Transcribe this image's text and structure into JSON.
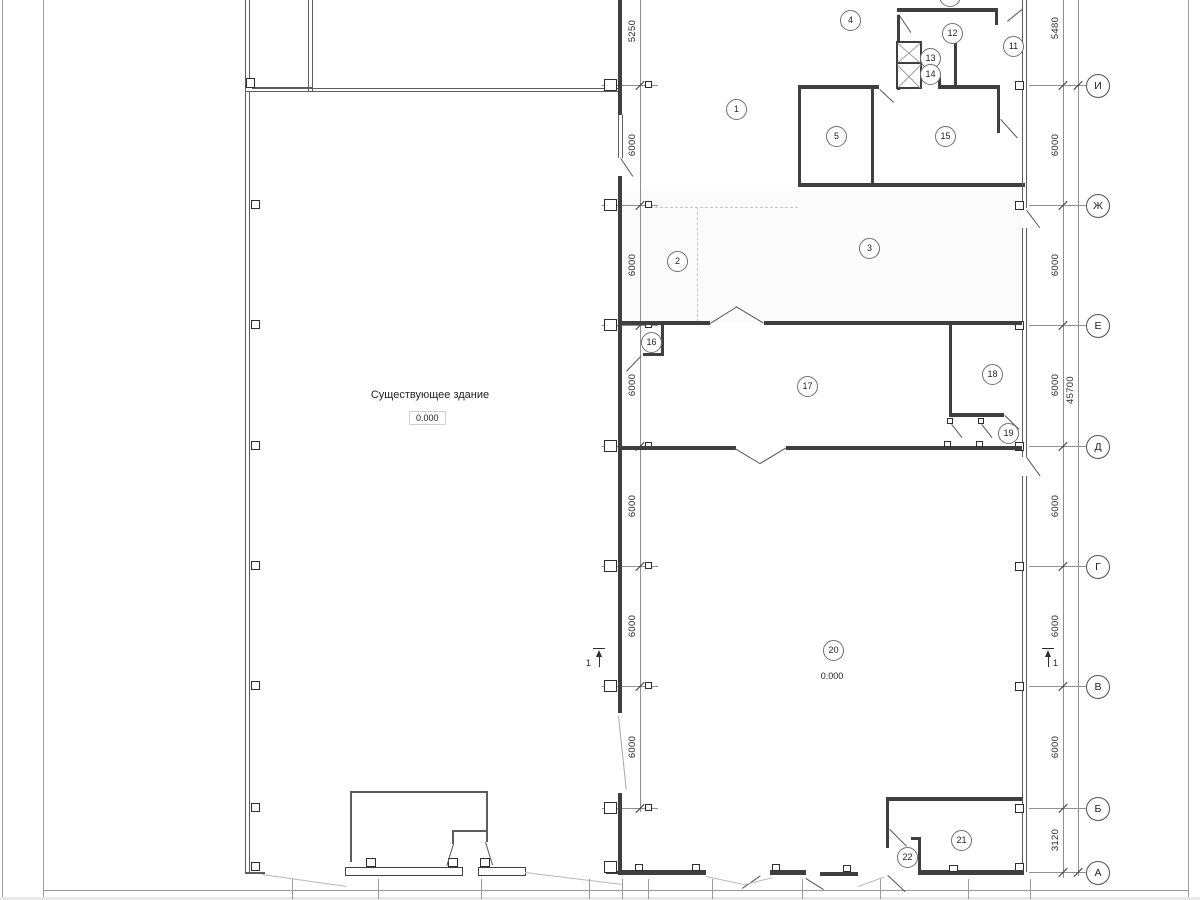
{
  "sheet": {
    "building_label": "Существующее здание",
    "elevation_boxed": "0.000",
    "elevation_floor": "0.000"
  },
  "rooms": [
    {
      "n": "1"
    },
    {
      "n": "2"
    },
    {
      "n": "3"
    },
    {
      "n": "4"
    },
    {
      "n": "5"
    },
    {
      "n": "11"
    },
    {
      "n": "12"
    },
    {
      "n": "13"
    },
    {
      "n": "14"
    },
    {
      "n": "15"
    },
    {
      "n": "16"
    },
    {
      "n": "17"
    },
    {
      "n": "18"
    },
    {
      "n": "19"
    },
    {
      "n": "20"
    },
    {
      "n": "21"
    },
    {
      "n": "22"
    }
  ],
  "axes": [
    {
      "label": "И"
    },
    {
      "label": "Ж"
    },
    {
      "label": "Е"
    },
    {
      "label": "Д"
    },
    {
      "label": "Г"
    },
    {
      "label": "В"
    },
    {
      "label": "Б"
    },
    {
      "label": "А"
    }
  ],
  "dims": {
    "left": [
      "5250",
      "6000",
      "6000",
      "6000",
      "6000",
      "6000",
      "6000"
    ],
    "right": [
      "5480",
      "6000",
      "6000",
      "6000",
      "6000",
      "6000",
      "6000",
      "3120"
    ],
    "total": "45700"
  },
  "section_marks": {
    "left": "1",
    "right": "1"
  }
}
